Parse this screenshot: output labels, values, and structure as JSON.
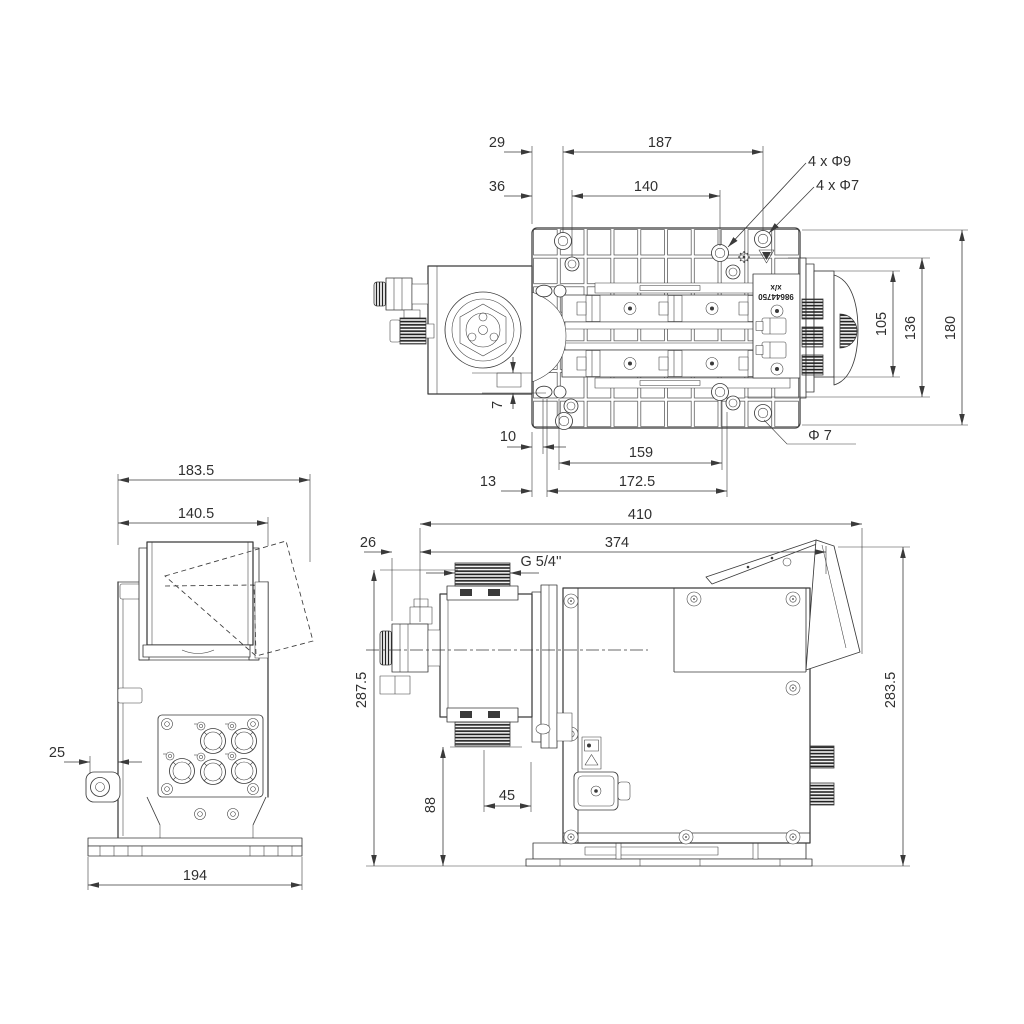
{
  "colors": {
    "line": "#3a3a3a",
    "text": "#303030",
    "background": "#ffffff"
  },
  "top_view": {
    "dims": {
      "d29": "29",
      "d187": "187",
      "d36": "36",
      "d140": "140",
      "holes_d9": "4 x Φ9",
      "holes_d7": "4 x Φ7",
      "d105": "105",
      "d136": "136",
      "d180": "180",
      "d7": "7",
      "d10": "10",
      "d159": "159",
      "dia7": "Φ 7",
      "d13": "13",
      "d172_5": "172.5"
    },
    "plate_label": {
      "line1": "x/x",
      "line2": "98644750"
    }
  },
  "back_view": {
    "dims": {
      "d183_5": "183.5",
      "d140_5": "140.5",
      "d25": "25",
      "d194": "194"
    }
  },
  "side_view": {
    "dims": {
      "d410": "410",
      "d374": "374",
      "d26": "26",
      "thread": "G 5/4''",
      "d287_5": "287.5",
      "d283_5": "283.5",
      "d88": "88",
      "d45": "45"
    }
  }
}
